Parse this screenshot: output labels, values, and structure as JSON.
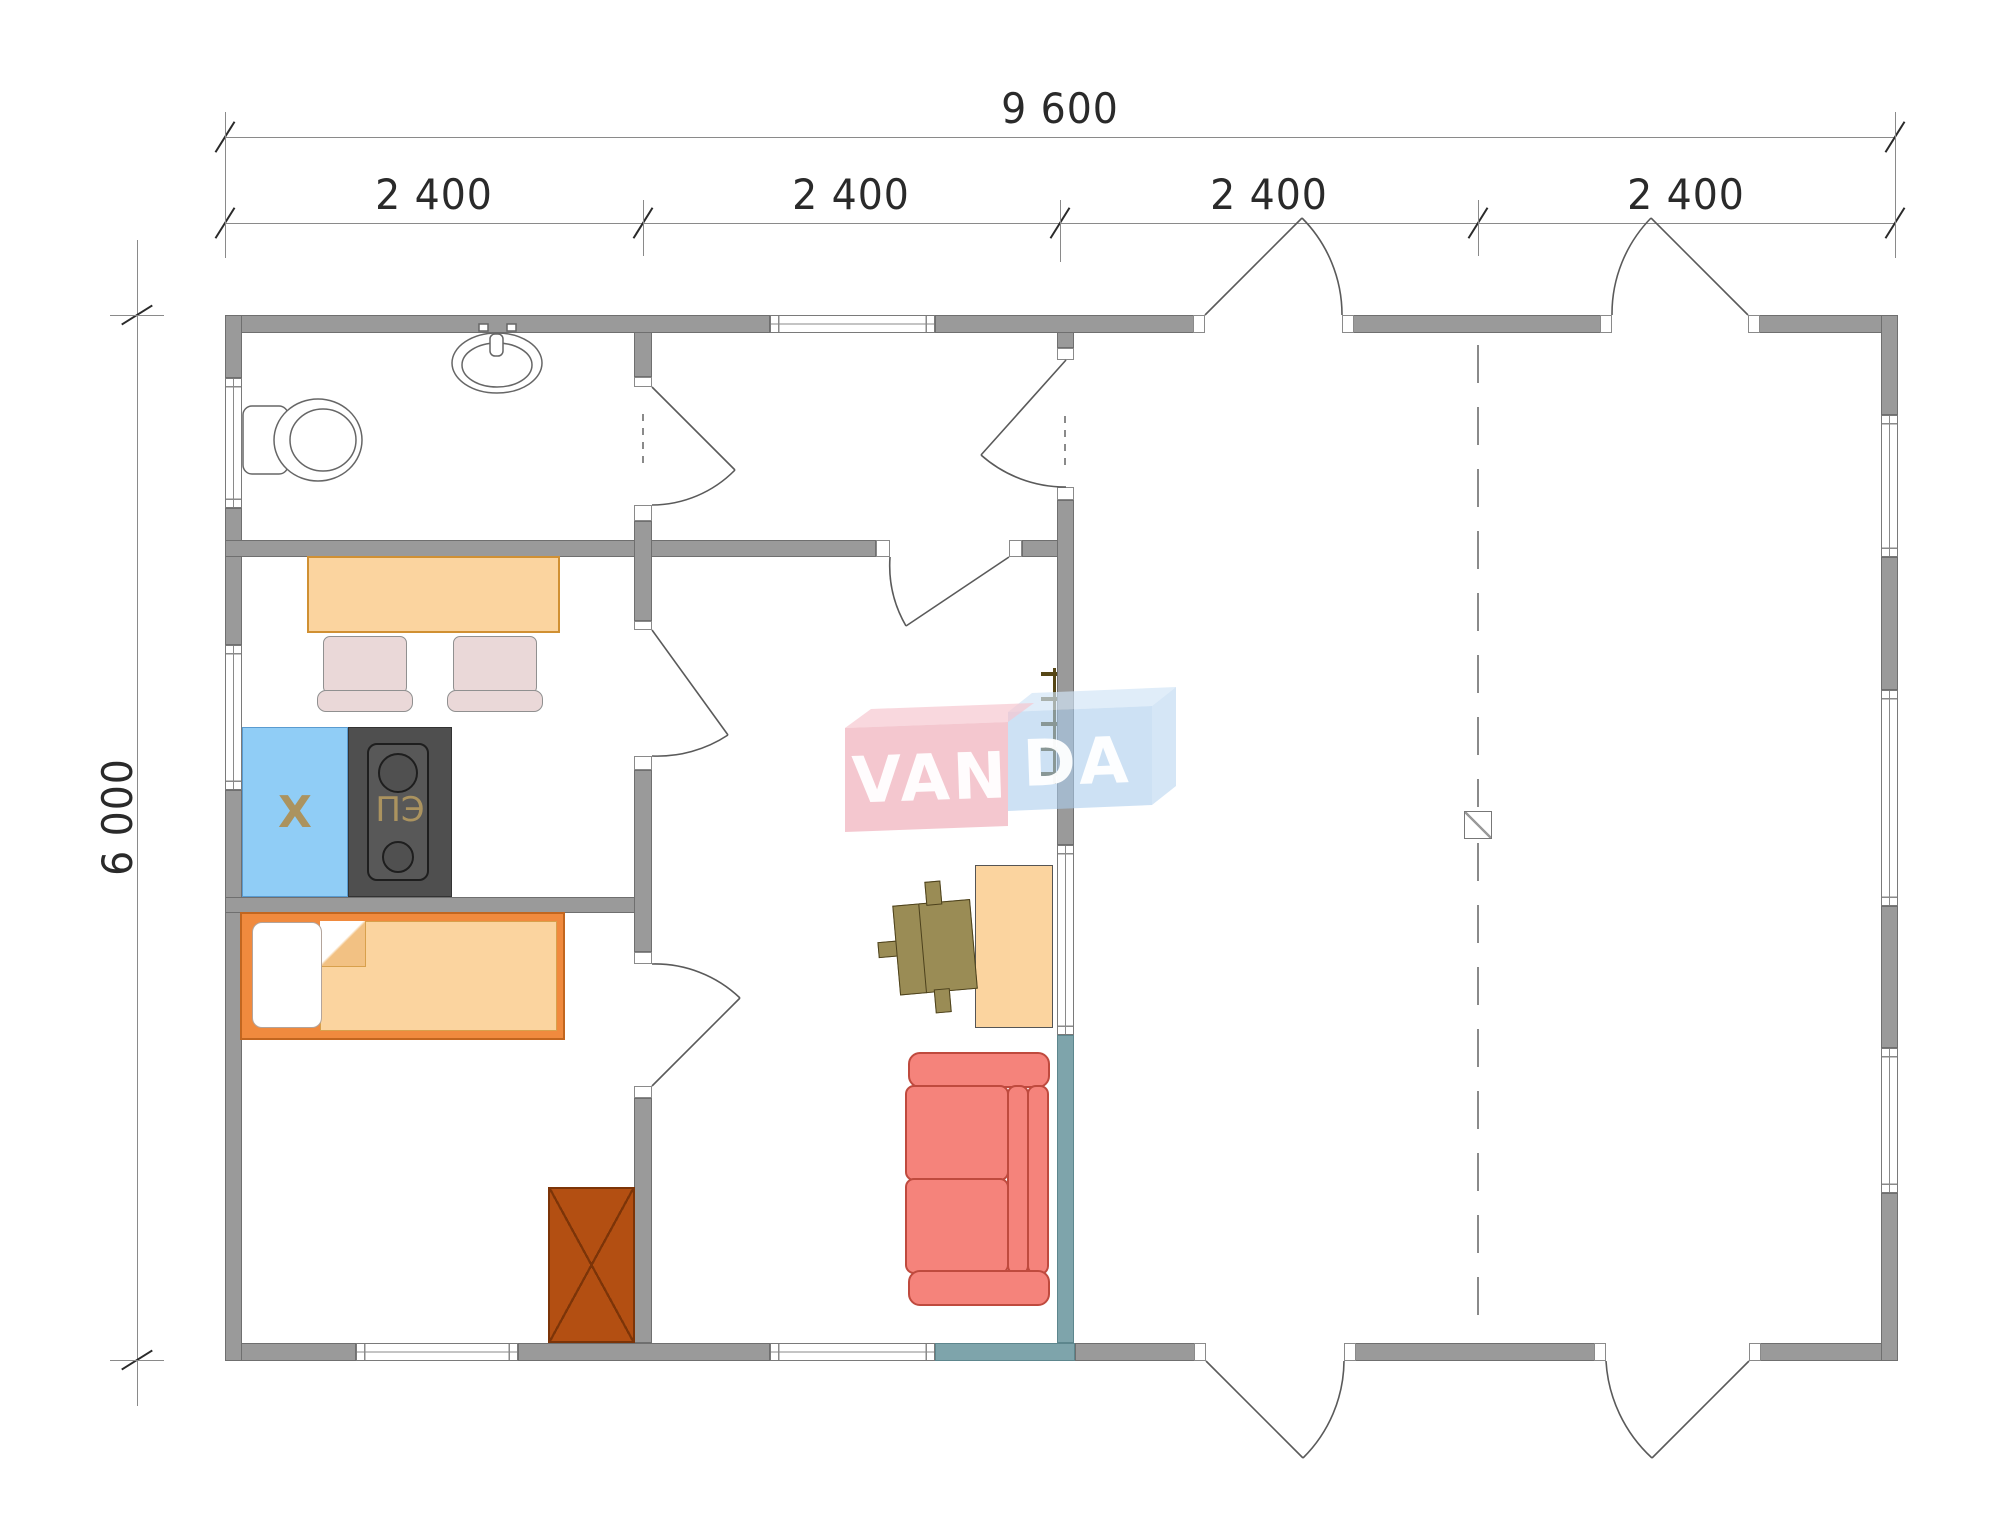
{
  "drawing": {
    "dimensions": {
      "overall_width": "9 600",
      "overall_height": "6 000",
      "modules": [
        "2 400",
        "2 400",
        "2 400",
        "2 400"
      ]
    },
    "labels": {
      "fridge": "Х",
      "stove": "ПЭ"
    },
    "watermark": {
      "left": "VAN",
      "right": "DA",
      "full": "VANDA"
    },
    "colors": {
      "wall": "#9a9a9a",
      "wallEdge": "#6f6f6f",
      "teal": "#7ea4ab",
      "peach": "#fbd49f",
      "peachEdge": "#d09033",
      "bedframe": "#f08a3e",
      "chair": "#ead8d8",
      "sofa": "#f5837b",
      "sofaEdge": "#bf4a3e",
      "fridge": "#90cdf6",
      "stove": "#4f4f4f",
      "applianceText": "#ab935f",
      "olive": "#9a8c55",
      "oliveEdge": "#4c411c",
      "wardrobe": "#b34f12",
      "wardrobeEdge": "#7c3408",
      "dim": "#2a2a2a",
      "line": "#8a8a8a",
      "door": "#5a5a5a",
      "wmPink": "rgba(238,164,178,0.62)",
      "wmPinkTop": "rgba(246,198,206,0.68)",
      "wmBlue": "rgba(172,205,237,0.60)",
      "wmBlueTop": "rgba(210,228,246,0.68)",
      "wmBlueSide": "rgba(188,214,240,0.62)",
      "wmText": "rgba(255,255,255,0.95)"
    }
  }
}
